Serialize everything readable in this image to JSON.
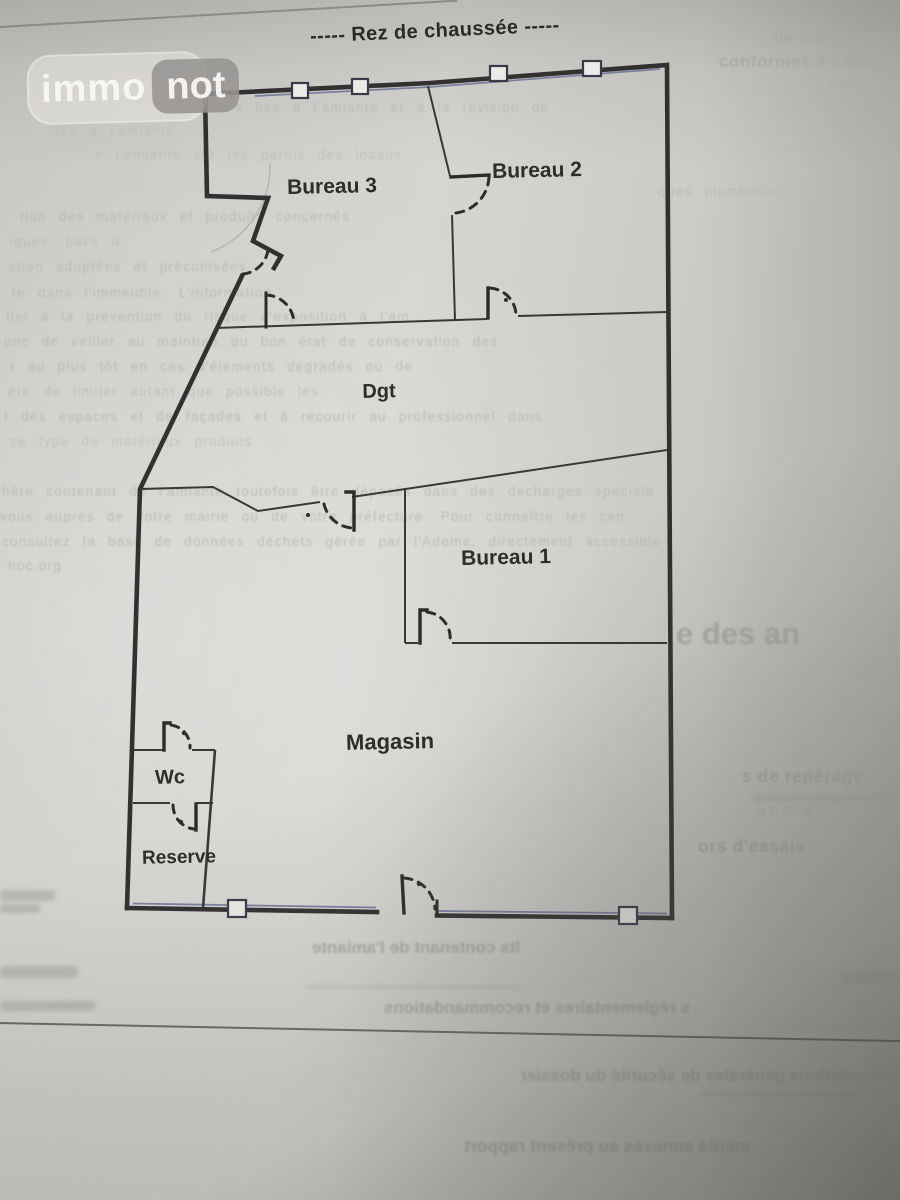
{
  "logo": {
    "immo": "immo",
    "not": "not"
  },
  "title": "-----  Rez de chaussée  -----",
  "rooms": {
    "bureau3": "Bureau 3",
    "bureau2": "Bureau 2",
    "bureau1": "Bureau 1",
    "dgt": "Dgt",
    "magasin": "Magasin",
    "wc": "Wc",
    "reserve": "Reserve"
  },
  "bleed": {
    "items": [
      {
        "text": "de conservation"
      },
      {
        "text": "conformes à l'annexe"
      },
      {
        "text": "cembre 2012"
      },
      {
        "text": "s liés à l'amiante et à la révision de"
      },
      {
        "text": "tés à l'amiante"
      },
      {
        "text": "e l'amiante sur les parois des locaux"
      },
      {
        "text": "ques plomberie)."
      },
      {
        "text": "tion des matériaux et produits concernés"
      },
      {
        "text": "iques, bacs d"
      },
      {
        "text": "ation adoptées et préconisées"
      },
      {
        "text": "te dans l'immeuble. L'information"
      },
      {
        "text": "tiel à la prévention du risque d'exposition à l'am"
      },
      {
        "text": "onc de veiller au maintien du bon état de conservation des"
      },
      {
        "text": "r au plus tôt en cas d'éléments dégradés ou de"
      },
      {
        "text": "ère de limiter autant que possible les"
      },
      {
        "text": "t des espaces et de façades et à recourir au professionnel dans"
      },
      {
        "text": "ce type de matériaux produits"
      },
      {
        "text": "hère contenant de l'amiante toutefois être déposés dans des décharges spéciale"
      },
      {
        "text": "vous auprès de votre mairie ou de votre préfecture. Pour connaître les cen"
      },
      {
        "text": "consultez la base de données déchets gérée par l'Ademe, directement accessible"
      },
      {
        "text": "noc.org"
      },
      {
        "text": "e des an"
      },
      {
        "text": "s de repérage"
      },
      {
        "text": "és 87 150   06 78"
      },
      {
        "text": "ors d'essais"
      },
      {
        "text": "lts contenant de l'amiante",
        "mirrored": true
      },
      {
        "text": "s réglementaires et recommandations",
        "mirrored": true
      },
      {
        "text": "mmandations générales de sécurité du dossier",
        "mirrored": true
      },
      {
        "text": "ments annexés au présent rapport",
        "mirrored": true
      }
    ]
  }
}
